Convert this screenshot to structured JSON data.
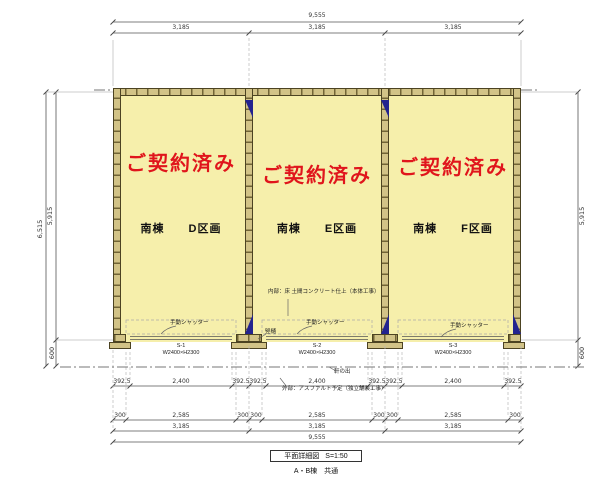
{
  "drawing": {
    "status_label": "ご契約済み",
    "units": [
      {
        "name": "南棟　　D区画",
        "shutter_code": "S-1",
        "shutter_size": "W2400×H2300"
      },
      {
        "name": "南棟　　E区画",
        "shutter_code": "S-2",
        "shutter_size": "W2400×H2300"
      },
      {
        "name": "南棟　　F区画",
        "shutter_code": "S-3",
        "shutter_size": "W2400×H2300"
      }
    ],
    "notes": {
      "shutter": "手動シャッター",
      "interior": "内部：床 土間コンクリート仕上（本体工事）",
      "exterior": "外部：アスファルト予定（独立舗装工事）",
      "eaves": "軒の出",
      "downspout": "竪樋"
    },
    "dimensions": {
      "top_total": "9,555",
      "top_units": [
        "3,185",
        "3,185",
        "3,185"
      ],
      "row1": [
        "392.5",
        "2,400",
        "392.5",
        "392.5",
        "2,400",
        "392.5",
        "392.5",
        "2,400",
        "392.5"
      ],
      "row2": [
        "300",
        "2,585",
        "300",
        "300",
        "2,585",
        "300",
        "300",
        "2,585",
        "300"
      ],
      "row3": [
        "3,185",
        "3,185",
        "3,185"
      ],
      "bottom_total": "9,555",
      "left_total": "6,515",
      "left_main": "5,915",
      "left_apron": "600",
      "right_main": "5,915",
      "right_apron": "600"
    },
    "title_block": {
      "title": "平面詳細図",
      "scale": "S=1:50",
      "subtitle": "A・B棟　共通"
    },
    "colors": {
      "interior": "#f6efab",
      "wall": "#d2c387",
      "status_red": "#e0151c",
      "brace_blue": "#23238f"
    }
  }
}
